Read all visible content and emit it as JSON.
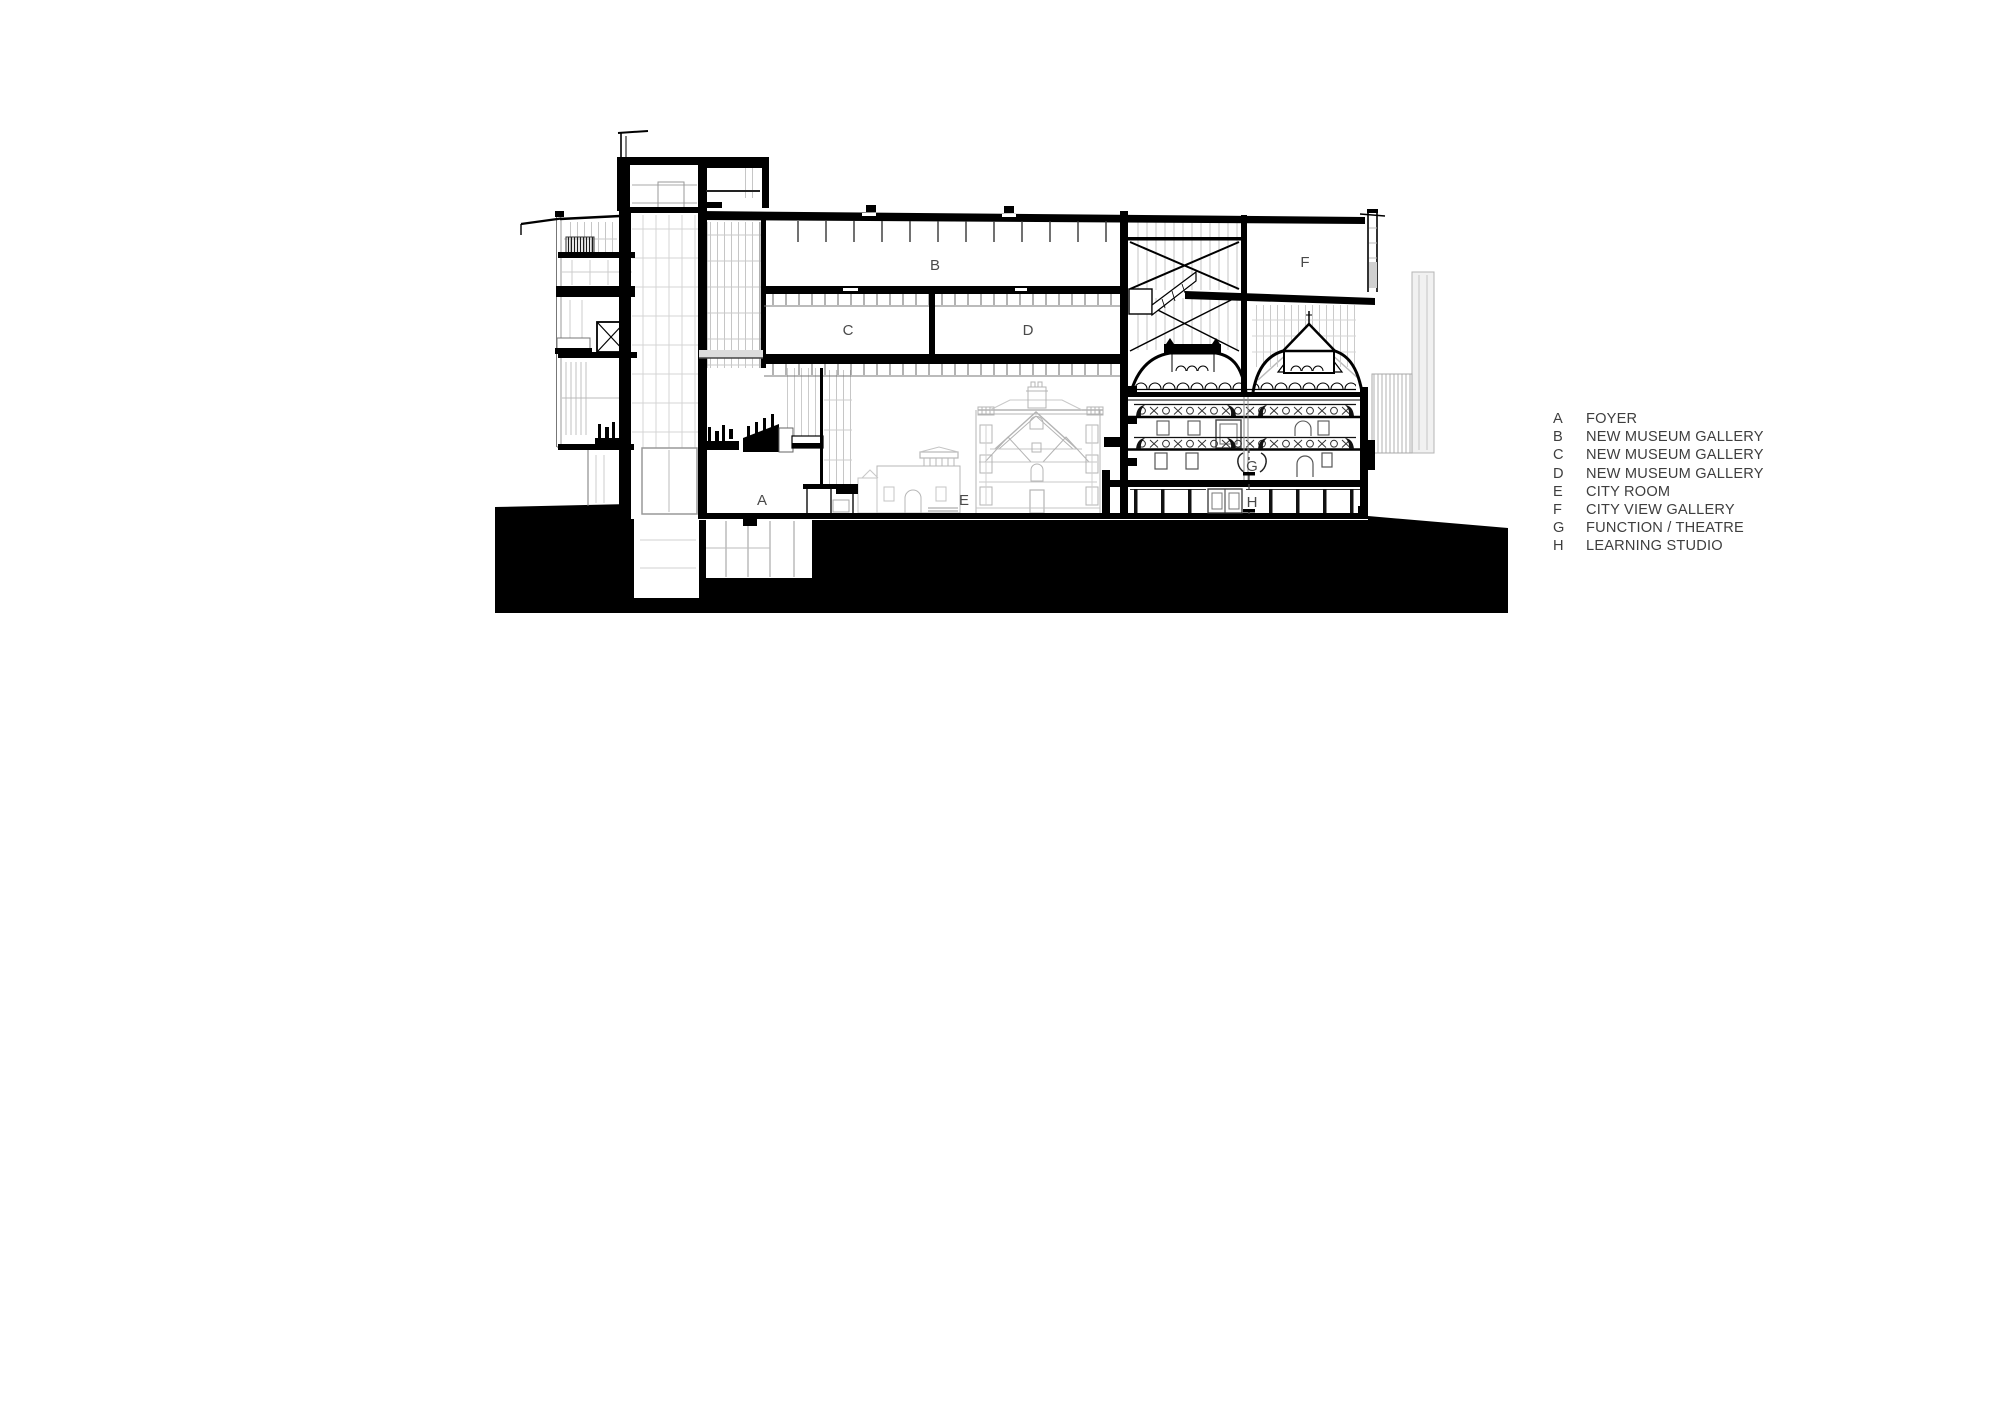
{
  "page": {
    "width": 2000,
    "height": 1414,
    "background": "#ffffff"
  },
  "drawing": {
    "description": "Black and white architectural long section through a museum with lift tower, stacked galleries, retained heritage buildings and ground poche",
    "room_letters": {
      "a": "A",
      "b": "B",
      "c": "C",
      "d": "D",
      "e": "E",
      "f": "F",
      "g": "G",
      "h": "H"
    }
  },
  "legend": {
    "items": [
      {
        "key": "A",
        "label": "FOYER"
      },
      {
        "key": "B",
        "label": "NEW MUSEUM GALLERY"
      },
      {
        "key": "C",
        "label": "NEW MUSEUM GALLERY"
      },
      {
        "key": "D",
        "label": "NEW MUSEUM GALLERY"
      },
      {
        "key": "E",
        "label": "CITY ROOM"
      },
      {
        "key": "F",
        "label": "CITY VIEW GALLERY"
      },
      {
        "key": "G",
        "label": "FUNCTION / THEATRE"
      },
      {
        "key": "H",
        "label": "LEARNING STUDIO"
      }
    ]
  },
  "colors": {
    "ink": "#000000",
    "label_gray": "#4a4a4a",
    "legend_gray": "#3e3e3e",
    "elevation_gray": "#b4b4b4",
    "grid_gray": "#c6c6c6"
  }
}
